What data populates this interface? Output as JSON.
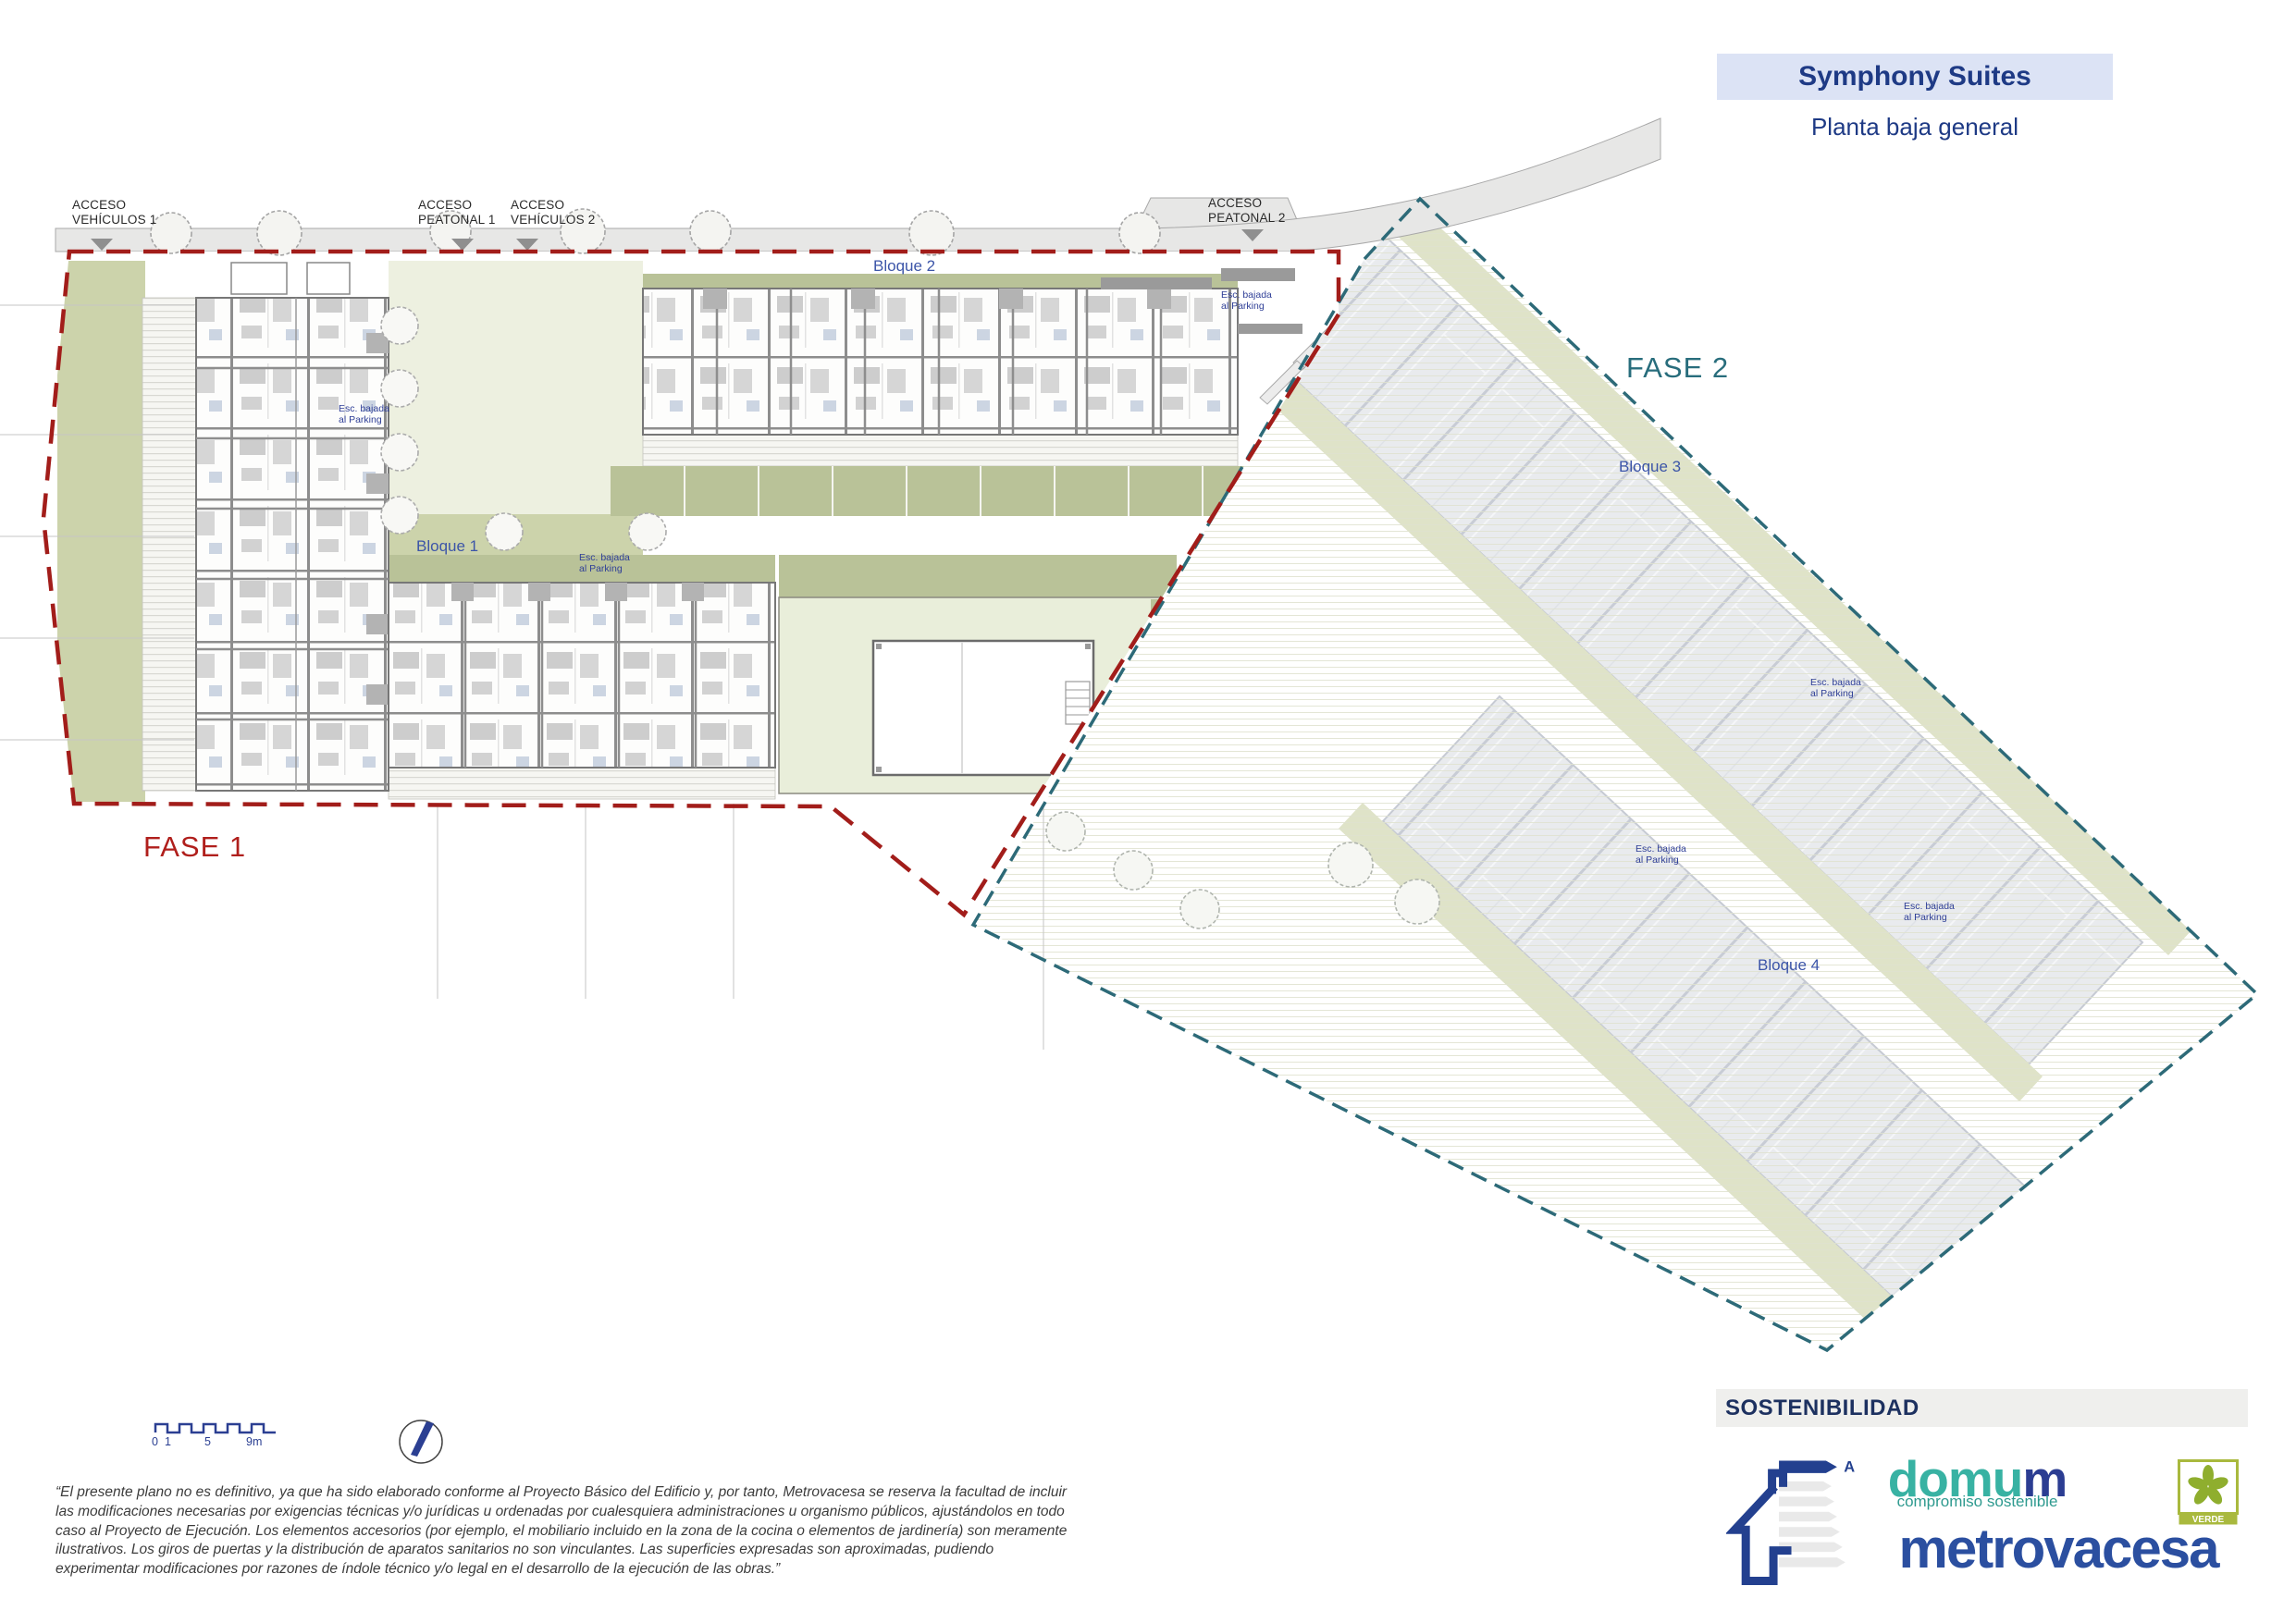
{
  "header": {
    "title": "Symphony Suites",
    "subtitle": "Planta baja general"
  },
  "plan": {
    "access": {
      "vehiculos1": "ACCESO\nVEHÍCULOS 1",
      "peatonal1": "ACCESO\nPEATONAL 1",
      "vehiculos2": "ACCESO\nVEHÍCULOS 2",
      "peatonal2": "ACCESO\nPEATONAL 2"
    },
    "fase1": "FASE 1",
    "fase2": "FASE 2",
    "bloques": {
      "b1": "Bloque 1",
      "b2": "Bloque 2",
      "b3": "Bloque 3",
      "b4": "Bloque 4"
    },
    "esc_label": "Esc. bajada\nal Parking",
    "colors": {
      "fase1_boundary": "#a21d1a",
      "fase2_boundary": "#2d6a78",
      "green_band": "#b9c298",
      "pale_green": "#edf0e0",
      "road_gray": "#e7e7e6"
    }
  },
  "scale_bar": {
    "t0": "0",
    "t1": "1",
    "t5": "5",
    "t9": "9m"
  },
  "disclaimer": "“El presente plano no es definitivo, ya que ha sido elaborado conforme al Proyecto Básico del Edificio y, por tanto, Metrovacesa se reserva la facultad de incluir las modificaciones necesarias por exigencias técnicas y/o jurídicas u ordenadas por cualesquiera administraciones u organismo públicos, ajustándolos en todo caso al Proyecto de Ejecución. Los elementos accesorios (por ejemplo, el mobiliario incluido en la zona de la cocina o elementos de jardinería) son meramente ilustrativos. Los giros de puertas y la distribución de aparatos sanitarios no son vinculantes. Las superficies expresadas son aproximadas, pudiendo experimentar modificaciones por razones de índole técnico y/o legal en el desarrollo de la ejecución de las obras.”",
  "footer": {
    "sostenibilidad": "SOSTENIBILIDAD",
    "domum_part1": "domu",
    "domum_part2": "m",
    "domum_tagline": "compromiso sostenible",
    "brand": "metrovacesa",
    "verde": "VERDE",
    "energy_class": "A"
  }
}
